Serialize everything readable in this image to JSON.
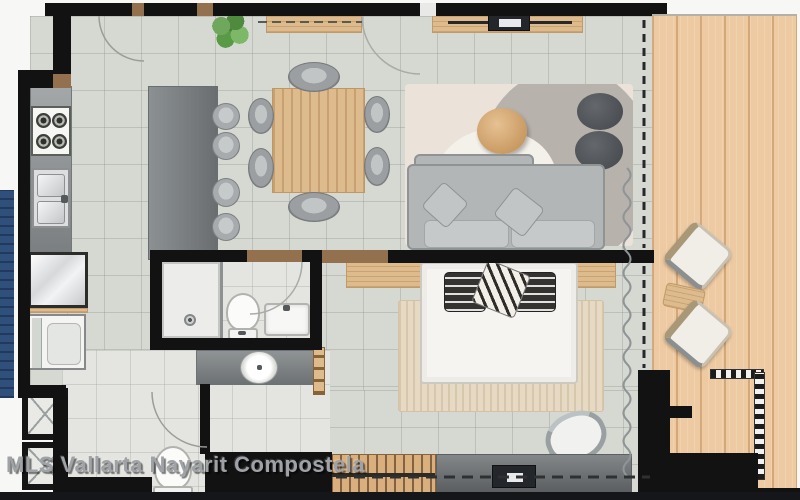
{
  "watermark": {
    "text": "MLS Vallarta Nayarit Compostela"
  },
  "palette": {
    "wall": "#121212",
    "tile": "#d6d8d2",
    "tilelight": "#e4e5e0",
    "deck": "#edcaa1",
    "wood": "#debb8d",
    "counter": "#8f9496",
    "island": "#7c8183",
    "console": "#6f7375",
    "sofa": "#b3b6b7",
    "cushion": "#c6c9ca",
    "rugbase": "#ebe3da",
    "ruggray": "#b8b2ac",
    "bedrug": "#e6dac4",
    "bed": "#f5f4f0",
    "water": "#30507c",
    "watermarkcolor": "#9fa2a6"
  },
  "diagram": {
    "type": "apartment-floor-plan",
    "rooms": [
      "kitchen",
      "dining-area",
      "living-room",
      "bedroom",
      "bathroom",
      "walk-in-closet",
      "laundry-storage",
      "terrace"
    ],
    "inventory": {
      "kitchen": [
        "four-burner-stove",
        "double-sink",
        "counter",
        "island",
        "bar-stools-x4",
        "refrigerator",
        "washer"
      ],
      "dining-area": [
        "wood-dining-table",
        "dining-chairs-x6",
        "plant",
        "sideboard"
      ],
      "living-room": [
        "sofa",
        "throw-pillows-x2",
        "area-rug",
        "round-coffee-table",
        "poufs-x2",
        "tv-console",
        "tv",
        "soundbar"
      ],
      "bedroom": [
        "double-bed",
        "pillows-x3",
        "wood-headboard",
        "area-rug",
        "accent-chair",
        "slatted-dresser",
        "media-console",
        "tv"
      ],
      "bathroom": [
        "shower",
        "toilet",
        "rectangular-sink",
        "vanity-counter",
        "vessel-sink",
        "towel-rack"
      ],
      "walk-in-closet": [
        "closet-box-x2",
        "guest-toilet",
        "door-swing"
      ],
      "terrace": [
        "lounge-chairs-x2",
        "side-table",
        "checkered-railing",
        "wood-deck"
      ]
    },
    "symbols": {
      "window-sliding-door": "dashed-line",
      "curtain": "wavy-line",
      "door-swing": "quarter-arc",
      "railing": "checkered-band"
    }
  }
}
